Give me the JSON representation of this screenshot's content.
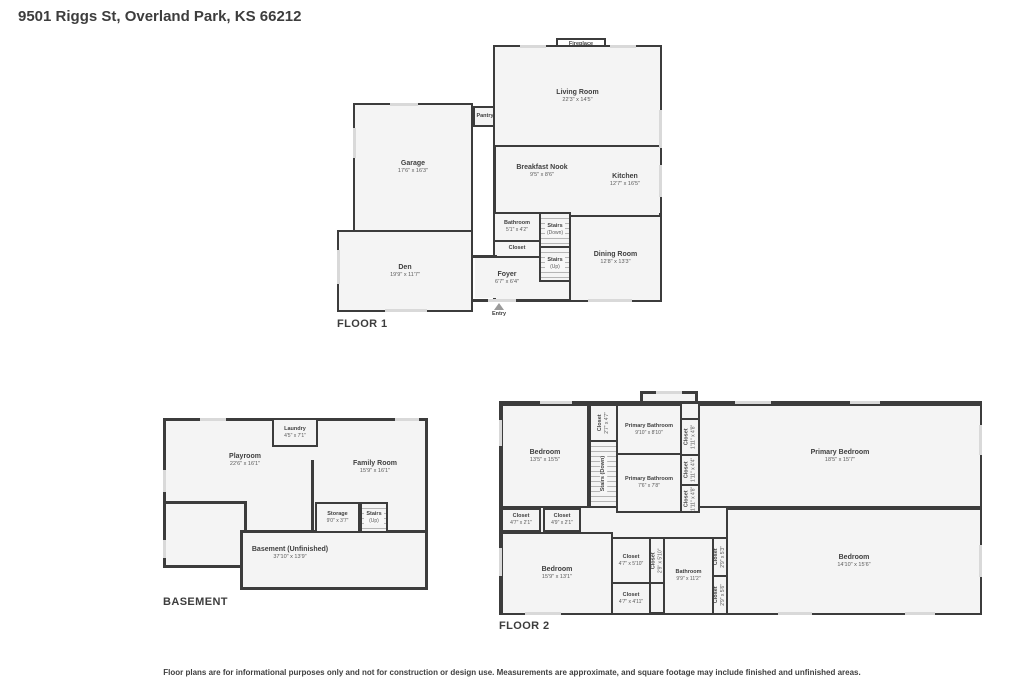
{
  "page": {
    "title": "9501 Riggs St, Overland Park, KS 66212",
    "disclaimer": "Floor plans are for informational purposes only and not for construction or design use. Measurements are approximate, and square footage may include finished and unfinished areas."
  },
  "colors": {
    "wall": "#3C3C3C",
    "room_fill": "#F4F4F4",
    "window_marker": "#D9D9D9",
    "text": "#3F3F3F"
  },
  "floor1": {
    "label": "FLOOR 1",
    "rooms": {
      "living_room": {
        "name": "Living Room",
        "dims": "22'3\" x 14'5\""
      },
      "fireplace": {
        "name": "Fireplace"
      },
      "garage": {
        "name": "Garage",
        "dims": "17'6\" x 16'3\""
      },
      "pantry": {
        "name": "Pantry"
      },
      "breakfast_nook": {
        "name": "Breakfast Nook",
        "dims": "9'5\" x 8'6\""
      },
      "kitchen": {
        "name": "Kitchen",
        "dims": "12'7\" x 16'5\""
      },
      "bathroom": {
        "name": "Bathroom",
        "dims": "5'1\" x 4'2\""
      },
      "stairs_down": {
        "name": "Stairs",
        "dims": "(Down)"
      },
      "closet": {
        "name": "Closet"
      },
      "stairs_up": {
        "name": "Stairs",
        "dims": "(Up)"
      },
      "dining_room": {
        "name": "Dining Room",
        "dims": "12'8\" x 13'3\""
      },
      "foyer": {
        "name": "Foyer",
        "dims": "6'7\" x 6'4\""
      },
      "den": {
        "name": "Den",
        "dims": "19'9\" x 11'7\""
      },
      "entry": {
        "name": "Entry"
      }
    }
  },
  "basement": {
    "label": "BASEMENT",
    "rooms": {
      "laundry": {
        "name": "Laundry",
        "dims": "4'5\" x 7'1\""
      },
      "playroom": {
        "name": "Playroom",
        "dims": "22'6\" x 16'1\""
      },
      "family_room": {
        "name": "Family Room",
        "dims": "15'9\" x 16'1\""
      },
      "storage": {
        "name": "Storage",
        "dims": "9'0\" x 3'7\""
      },
      "stairs_up": {
        "name": "Stairs",
        "dims": "(Up)"
      },
      "unfinished": {
        "name": "Basement (Unfinished)",
        "dims": "37'10\" x 13'9\""
      }
    }
  },
  "floor2": {
    "label": "FLOOR 2",
    "rooms": {
      "bedroom_top_left": {
        "name": "Bedroom",
        "dims": "13'5\" x 15'5\""
      },
      "closet_stair": {
        "name": "Closet",
        "dims": "2'7\" x 4'7\""
      },
      "stairs_down": {
        "name": "Stairs (Down)"
      },
      "primary_bathroom_top": {
        "name": "Primary Bathroom",
        "dims": "9'10\" x 8'10\""
      },
      "closet_pb1": {
        "name": "Closet",
        "dims": "1'11\" x 4'8\""
      },
      "closet_pb2": {
        "name": "Closet",
        "dims": "1'11\" x 4'4\""
      },
      "primary_bedroom": {
        "name": "Primary Bedroom",
        "dims": "18'5\" x 15'7\""
      },
      "primary_bathroom_lower": {
        "name": "Primary Bathroom",
        "dims": "7'6\" x 7'8\""
      },
      "closet_pb3": {
        "name": "Closet",
        "dims": "1'11\" x 4'8\""
      },
      "closet_hall1": {
        "name": "Closet",
        "dims": "4'7\" x 2'1\""
      },
      "closet_hall2": {
        "name": "Closet",
        "dims": "4'9\" x 2'1\""
      },
      "bedroom_bottom_left": {
        "name": "Bedroom",
        "dims": "15'9\" x 13'1\""
      },
      "closet_bl": {
        "name": "Closet",
        "dims": "4'7\" x 5'10\""
      },
      "closet_bl2": {
        "name": "Closet",
        "dims": "2'9\" x 5'10\""
      },
      "bathroom": {
        "name": "Bathroom",
        "dims": "9'9\" x 11'2\""
      },
      "closet_bath1": {
        "name": "Closet",
        "dims": "2'9\" x 5'3\""
      },
      "closet_bath2": {
        "name": "Closet",
        "dims": "2'9\" x 5'6\""
      },
      "bedroom_bottom_right": {
        "name": "Bedroom",
        "dims": "14'10\" x 15'6\""
      },
      "closet_bottom": {
        "name": "Closet",
        "dims": "4'7\" x 4'11\""
      }
    }
  }
}
